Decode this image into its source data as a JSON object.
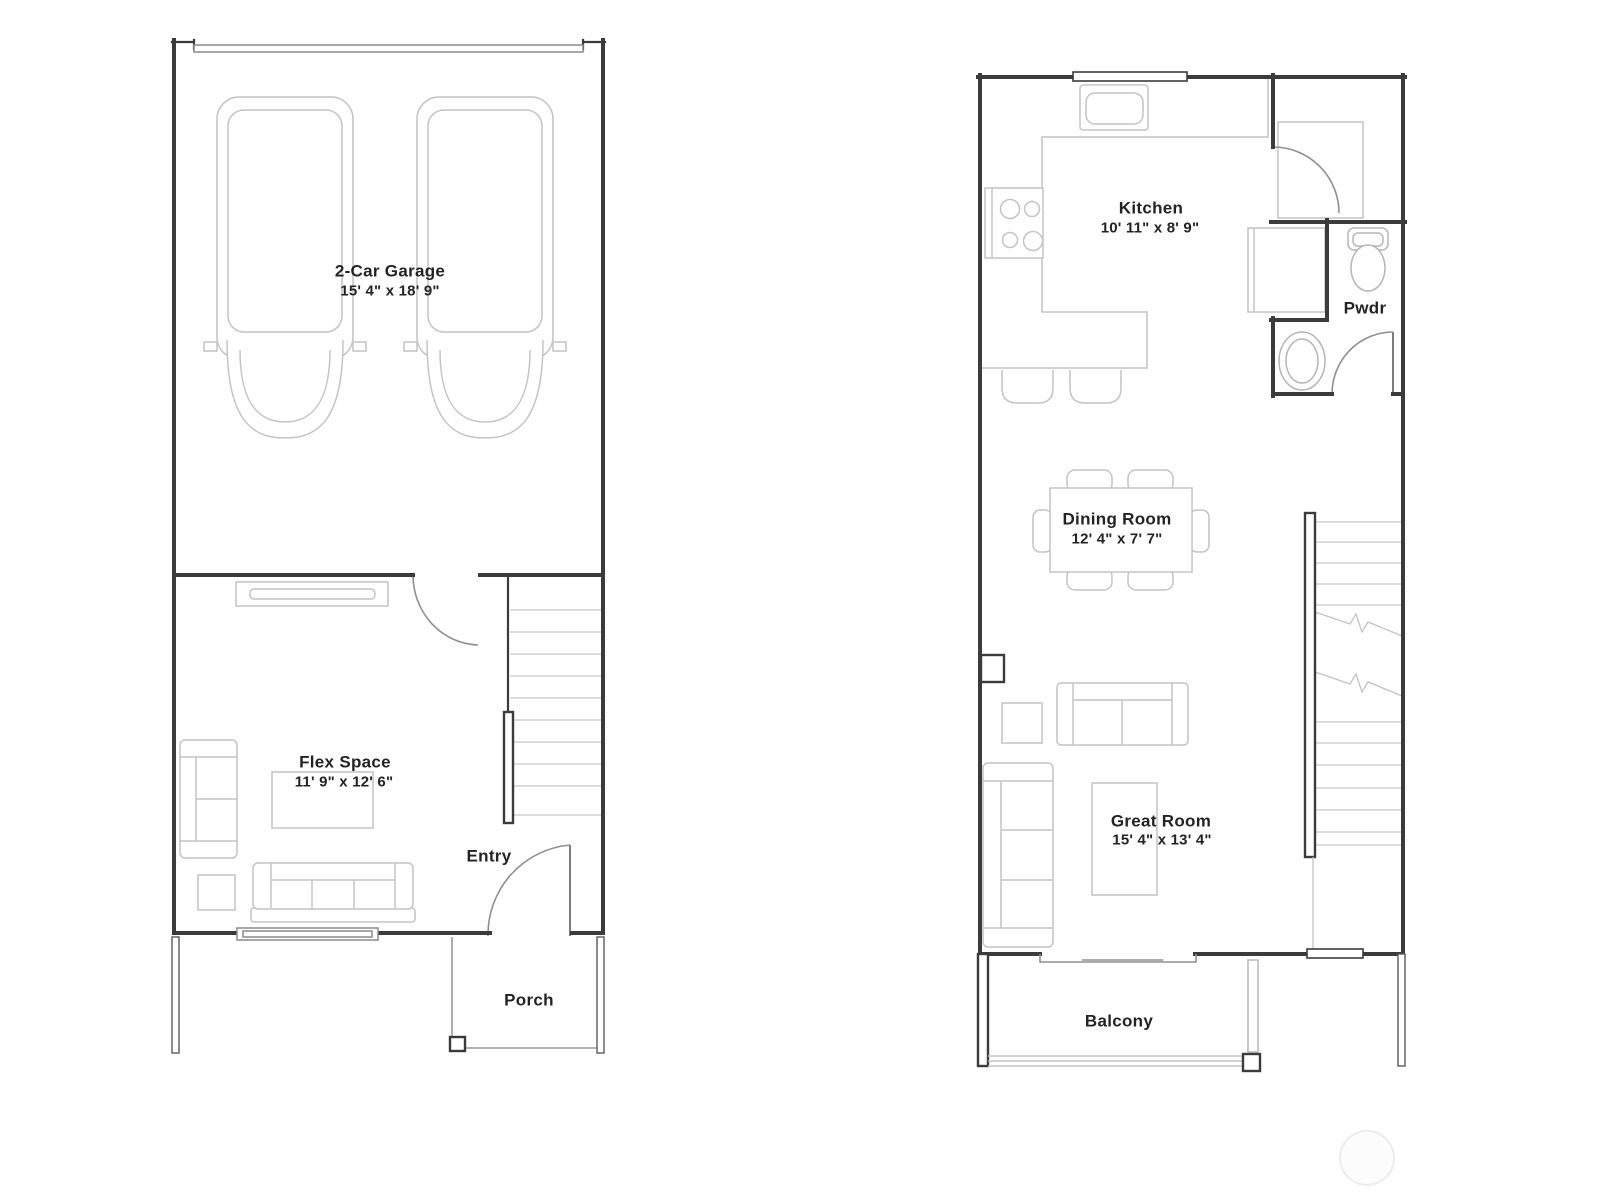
{
  "floor1": {
    "garage": {
      "name": "2-Car Garage",
      "dims": "15' 4\" x 18' 9\""
    },
    "flex_space": {
      "name": "Flex Space",
      "dims": "11' 9\" x 12' 6\""
    },
    "entry": {
      "name": "Entry"
    },
    "porch": {
      "name": "Porch"
    }
  },
  "floor2": {
    "kitchen": {
      "name": "Kitchen",
      "dims": "10' 11\" x 8' 9\""
    },
    "powder_room": {
      "name": "Pwdr"
    },
    "dining_room": {
      "name": "Dining Room",
      "dims": "12' 4\" x 7' 7\""
    },
    "great_room": {
      "name": "Great Room",
      "dims": "15' 4\" x 13' 4\""
    },
    "balcony": {
      "name": "Balcony"
    }
  },
  "colors": {
    "wall": "#3b3b3b",
    "furniture": "#c4c4c4",
    "door_arc": "#8f8f8f",
    "text": "#232323",
    "background": "#ffffff"
  }
}
